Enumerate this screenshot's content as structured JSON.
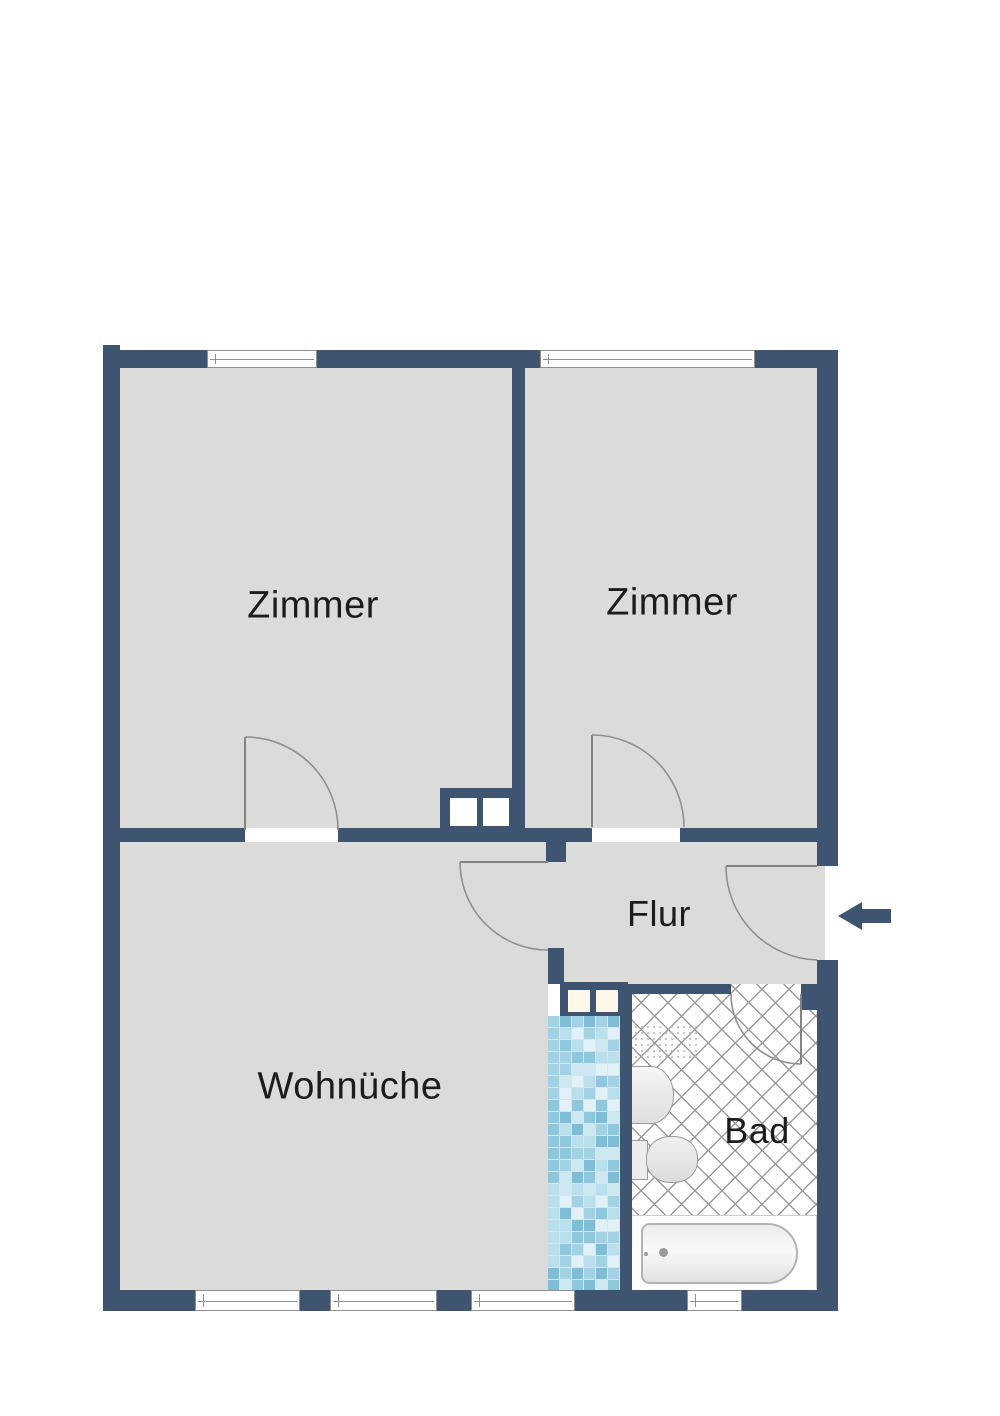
{
  "floorplan": {
    "title": "Apartment floor plan",
    "rooms": [
      {
        "id": "zimmer-left",
        "label": "Zimmer"
      },
      {
        "id": "zimmer-right",
        "label": "Zimmer"
      },
      {
        "id": "flur",
        "label": "Flur"
      },
      {
        "id": "wohnkueche",
        "label": "Wohnüche"
      },
      {
        "id": "bad",
        "label": "Bad"
      }
    ],
    "entrance": {
      "symbol": "left-arrow",
      "meaning": "entrance into Flur"
    },
    "colors": {
      "wall": "#3e5470",
      "floor": "#dbdbd9",
      "door_arc": "#8f8f8f",
      "window_frame": "#909090",
      "lattice_line": "#9b9b9b",
      "text": "#1c1c1c",
      "shaft_fill": "#fdf8e9",
      "mosaic_palette": [
        "#a3d2e4",
        "#cde8f1",
        "#e2f1f7",
        "#7fbdd7",
        "#b9dfec",
        "#8fc8dd"
      ]
    }
  }
}
